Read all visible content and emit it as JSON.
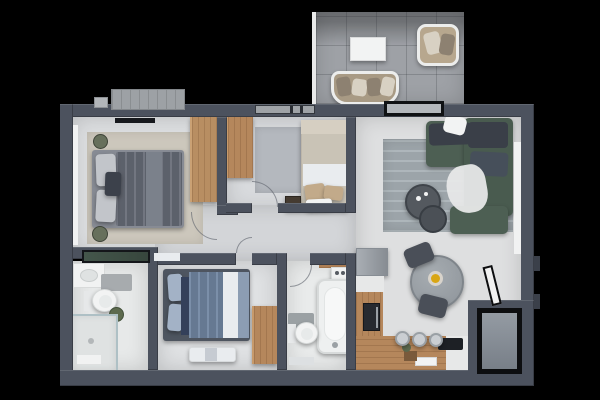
{
  "scene": {
    "type": "3d-rendered-apartment-floor-plan",
    "view": "top-down",
    "background": "#000000",
    "rooms": [
      {
        "id": "master-bedroom",
        "furniture": [
          "double-bed-gray",
          "beige-rug",
          "wood-wardrobe",
          "wall-tv",
          "potted-plants",
          "window"
        ]
      },
      {
        "id": "bedroom-2",
        "furniture": [
          "double-bed-blue",
          "foot-bench",
          "wood-wardrobe"
        ]
      },
      {
        "id": "bedroom-3",
        "furniture": [
          "single-bed",
          "wood-wardrobe",
          "gray-rug",
          "dark-nightstand",
          "window"
        ]
      },
      {
        "id": "living-room",
        "furniture": [
          "green-corner-sofa",
          "blue-gray-rug",
          "round-coffee-tables",
          "white-throw",
          "window",
          "balcony-sliding-door"
        ]
      },
      {
        "id": "dining-area",
        "furniture": [
          "round-gray-table",
          "two-dark-chairs",
          "yellow-fruit-bowl",
          "open-entry-door"
        ]
      },
      {
        "id": "kitchen",
        "furniture": [
          "gray-fridge",
          "white-counter",
          "oven",
          "wood-cabinets",
          "cooktop",
          "bar-stools",
          "cutting-board",
          "plant"
        ]
      },
      {
        "id": "bathroom-1",
        "furniture": [
          "vanity-sink",
          "toilet",
          "walk-in-shower",
          "glass-screen-green",
          "plant",
          "bath-mat"
        ]
      },
      {
        "id": "bathroom-2",
        "furniture": [
          "bathtub",
          "toilet",
          "washing-machine",
          "wood-shelf",
          "bath-mat"
        ]
      },
      {
        "id": "balcony",
        "furniture": [
          "tile-floor",
          "white-coffee-table",
          "wicker-armchair",
          "loveseat-with-cushions"
        ]
      },
      {
        "id": "entry",
        "furniture": [
          "door-leaf",
          "vestibule-steps"
        ]
      },
      {
        "id": "exterior",
        "furniture": [
          "ac-unit-large",
          "ac-unit-small",
          "wall-nubs"
        ]
      }
    ]
  },
  "palette": {
    "background": "#000000",
    "wall": "#4c525e",
    "wall_dark": "#3b404a",
    "floor_light": "#dcdee0",
    "floor_cool": "#d8dadd",
    "floor_living": "#dedfe0",
    "corridor": "#d3d5d8",
    "bath_floor": "#e7e9e9",
    "bath2_floor": "#e9ebeb",
    "bed2_floor": "#dfe1e3",
    "balcony_tile": "#9ea1a6",
    "balcony_edge": "#e9eaea",
    "rug_beige": "#ccc7bc",
    "rug_gray": "#b4b8be",
    "rug_blue": "#a9b2b7",
    "wood": "#b5875c",
    "wood_light": "#b88e62",
    "wood_dark": "#ad7f55",
    "sofa_green": "#4d5f53",
    "sofa_green2": "#495b4f",
    "cushion_dark": "#3a3f48",
    "cushion_mid": "#464f5a",
    "bed_frame_gray": "#878b94",
    "duvet_gray": "#676c77",
    "duvet_fold": "#7b818b",
    "pillow_light": "#c2c5ca",
    "pillow_dark": "#3c414b",
    "bed2_frame": "#4e5560",
    "duvet_blue": "#7187a3",
    "duvet_blue_end": "#8c9db3",
    "pillow_blue": "#a3b2c6",
    "navy": "#34405a",
    "white": "#f2f3f3",
    "off_white": "#e7e8e8",
    "runner_white": "#e9ecef",
    "headboard_tan": "#d6cfc2",
    "blanket_tan": "#c9c3b6",
    "pillow_tan": "#c2aa8a",
    "table_gray": "#9aa0a5",
    "chair_dark": "#4a4f58",
    "stool_gray": "#caced2",
    "fruit_yellow": "#d9a614",
    "fruit_plate": "#d8d3cb",
    "appliance_dark": "#272a30",
    "cooktop_black": "#1d2025",
    "fridge_gray": "#9aa0a7",
    "glass_green": "#41534a",
    "glass_blue": "#aec0c5",
    "entry_floor": "#8f969e",
    "door_black": "#0d0e10",
    "ac_gray": "#9da1a5",
    "plant_green": "#5d6a4e",
    "plant_dark": "#67705c",
    "wicker_tan": "#b7a78e",
    "seat_tan": "#a89a84",
    "pillow_cream": "#d8d1c3",
    "pillow_taupe": "#8d8171",
    "tv_black": "#17191d",
    "panel_gray": "#a7abae",
    "window_white": "#f1f2f2",
    "niche_gray": "#9ba1a4",
    "mat_gray": "#dde0e2"
  }
}
